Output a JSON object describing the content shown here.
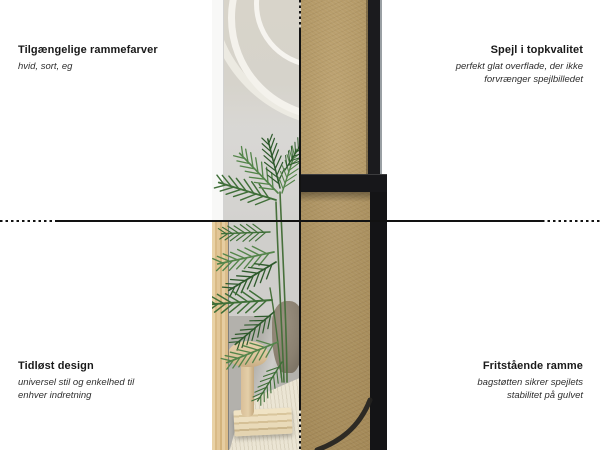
{
  "annotations": {
    "top_left": {
      "title": "Tilgængelige rammefarver",
      "subtitle": "hvid, sort, eg"
    },
    "top_right": {
      "title": "Spejl i topkvalitet",
      "subtitle": "perfekt glat overflade, der ikke forvrænger spejlbilledet"
    },
    "bottom_left": {
      "title": "Tidløst design",
      "subtitle": "universel stil og enkelhed til enhver indretning"
    },
    "bottom_right": {
      "title": "Fritstående ramme",
      "subtitle": "bagstøtten sikrer spejlets stabilitet på gulvet"
    }
  },
  "colors": {
    "background": "#ffffff",
    "divider_line": "#121212",
    "title_text": "#191919",
    "subtitle_text": "#2e2e2e",
    "mdf_board": "#b79a63",
    "black_frame": "#17171a",
    "oak_frame": "#ddbe8f",
    "white_frame": "#f8f8f7",
    "plant_green": "#3f6f38"
  }
}
